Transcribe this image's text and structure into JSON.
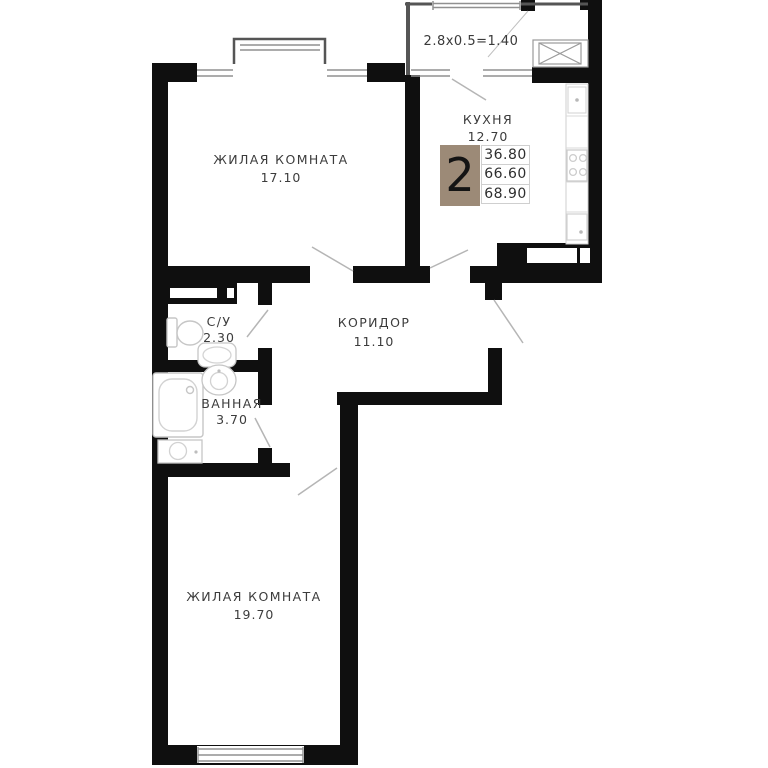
{
  "plan": {
    "title": "2-room apartment floor plan",
    "rooms": [
      {
        "name": "ЖИЛАЯ КОМНАТА",
        "area": "17.10"
      },
      {
        "name": "КУХНЯ",
        "area": "12.70"
      },
      {
        "name": "С/У",
        "area": "2.30"
      },
      {
        "name": "ВАННАЯ",
        "area": "3.70"
      },
      {
        "name": "КОРИДОР",
        "area": "11.10"
      },
      {
        "name": "ЖИЛАЯ КОМНАТА",
        "area": "19.70"
      }
    ],
    "balcony": {
      "formula": "2.8x0.5=1.40"
    },
    "info": {
      "rooms_count": "2",
      "values": [
        "36.80",
        "66.60",
        "68.90"
      ]
    },
    "colors": {
      "wall": "#0f0f0f",
      "accent": "#9c8a77",
      "fixture_line": "#c6c6c6",
      "window_line": "#909090",
      "door_line": "#b5b5b5",
      "text": "#3c3c3c"
    }
  }
}
